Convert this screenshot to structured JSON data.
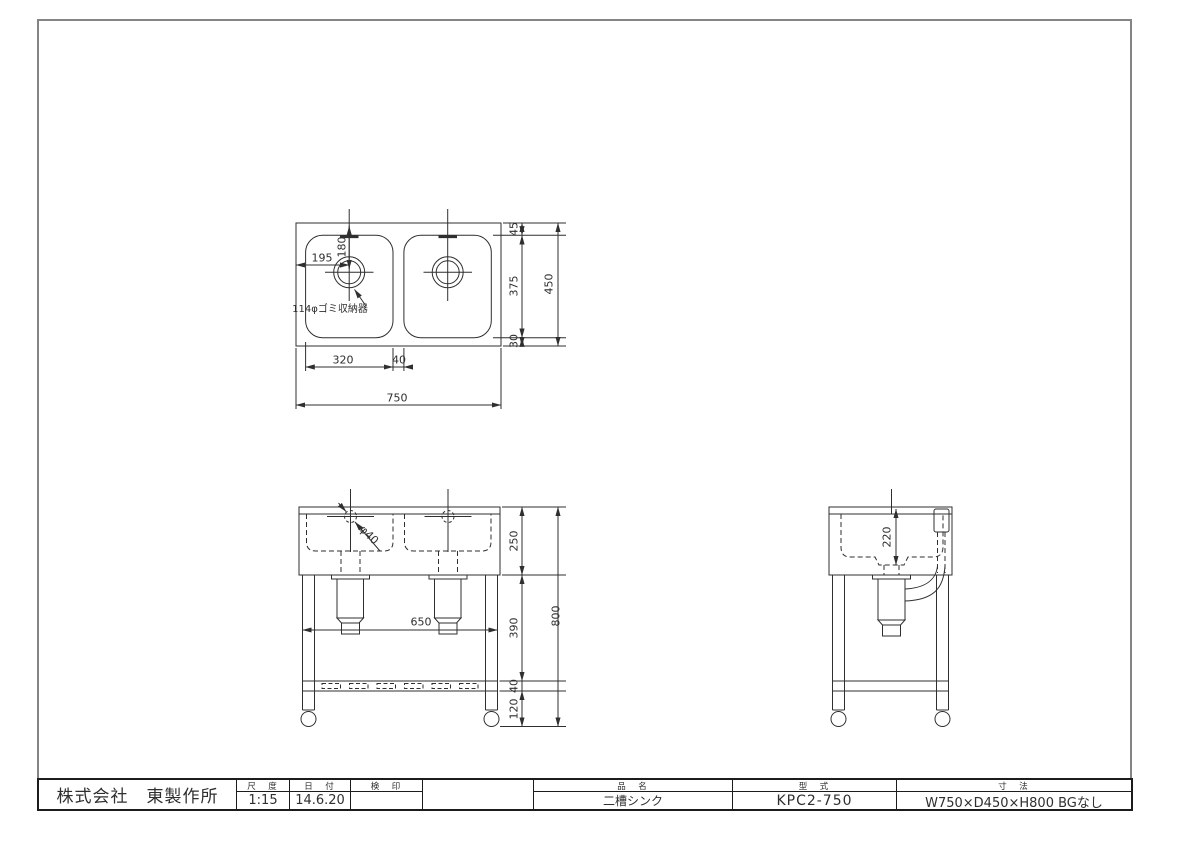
{
  "title_block": {
    "company": "株式会社　東製作所",
    "scale_label": "尺　度",
    "scale_value": "1:15",
    "date_label": "日　付",
    "date_value": "14.6.20",
    "stamp_label": "検　印",
    "stamp_value": "",
    "product_label": "品　名",
    "product_value": "二槽シンク",
    "model_label": "型　式",
    "model_value": "KPC2-750",
    "size_label": "寸　法",
    "size_value": "W750×D450×H800 BGなし"
  },
  "top_view": {
    "dim_overall_width": "750",
    "dim_basin_width": "320",
    "dim_basin_gap": "40",
    "dim_drain_offset_x": "195",
    "dim_drain_offset_y": "180",
    "drain_note": "114φゴミ収納器",
    "dim_overall_depth": "450",
    "dim_margin_front": "45",
    "dim_basin_depth": "375",
    "dim_margin_back": "30"
  },
  "front_view": {
    "dim_overall_height": "800",
    "dim_body_height": "250",
    "dim_leg_upper": "390",
    "dim_rail": "40",
    "dim_leg_lower": "120",
    "dim_leg_span": "650",
    "dim_drain_dia": "φ40"
  },
  "side_view": {
    "dim_basin_inner_depth": "220"
  }
}
